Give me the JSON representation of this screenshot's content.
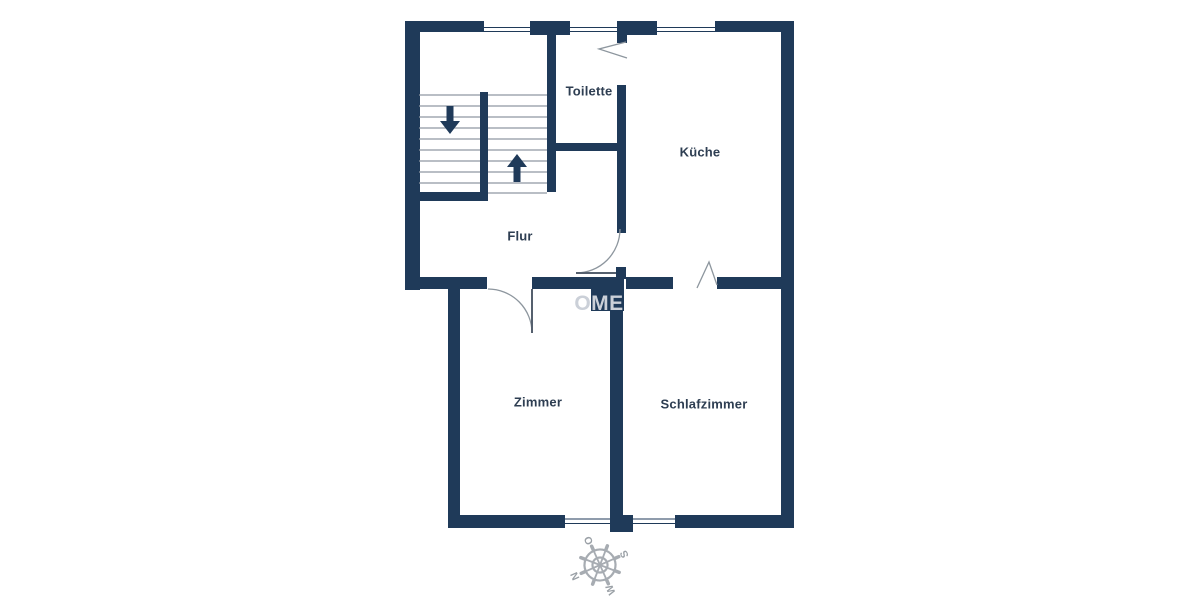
{
  "plan": {
    "type": "apartment-floor-plan",
    "rooms": {
      "toilette": "Toilette",
      "kueche": "Küche",
      "flur": "Flur",
      "zimmer": "Zimmer",
      "schlafzimmer": "Schlafzimmer"
    },
    "watermark": "OME",
    "compass": {
      "north": "N",
      "east": "O",
      "south": "S",
      "west": "W"
    },
    "colors": {
      "wall": "#1f3a59",
      "room_label": "#2e3e52",
      "stair_tread": "#8f98a2",
      "door_arc": "#8d969e",
      "watermark": "#cbd0d8",
      "compass": "#a7acb2",
      "background": "#ffffff"
    }
  }
}
